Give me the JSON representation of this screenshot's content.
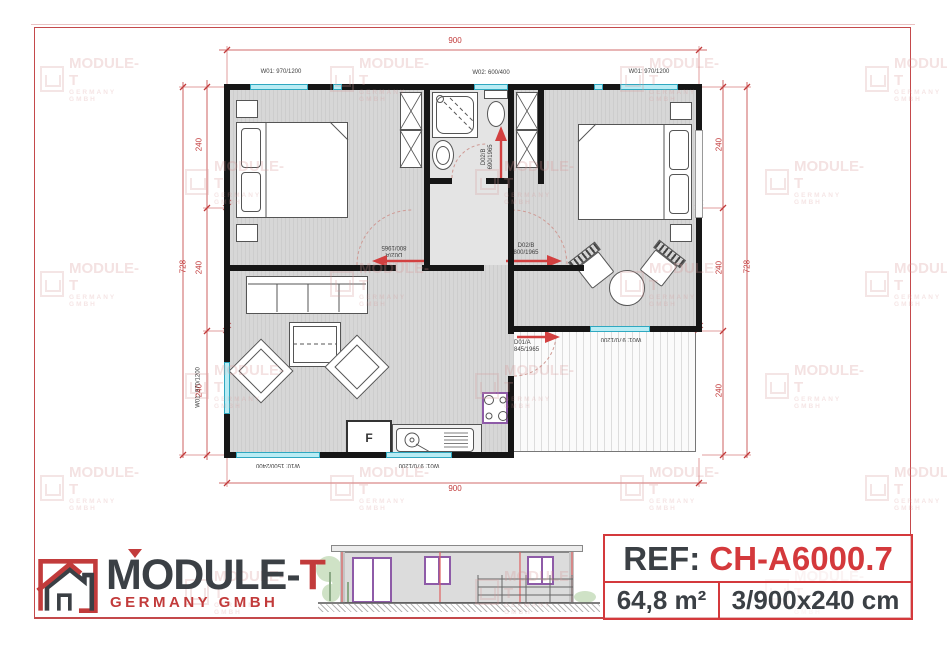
{
  "watermark": {
    "brand": "MODULE-T",
    "subtitle": "GERMANY GMBH"
  },
  "dimensions": {
    "width": "900",
    "height": "728",
    "module": "240"
  },
  "window_labels": {
    "w01": "W01: 970/1200",
    "w02": "W02: 600/400",
    "w10": "W10: 1500/2400"
  },
  "door_labels": {
    "bath": {
      "code": "D02/B",
      "size": "690/1965"
    },
    "bedroom1": {
      "code": "D02/A",
      "size": "800/1965"
    },
    "bedroom2": {
      "code": "D02/B",
      "size": "800/1965"
    },
    "entrance": {
      "code": "D01/A",
      "size": "845/1965"
    }
  },
  "plan_labels": {
    "fridge": "F"
  },
  "logo": {
    "brand": "MODULE-",
    "accent": "T",
    "subtitle": "GERMANY GMBH"
  },
  "ref_block": {
    "label": "REF:",
    "code": "CH-A6000.7",
    "area": "64,8 m²",
    "config": "3/900x240 cm"
  },
  "colors": {
    "accent_red": "#c23b3b",
    "window_cyan": "#b9ecf4",
    "frame_purple": "#8e5ba8"
  }
}
